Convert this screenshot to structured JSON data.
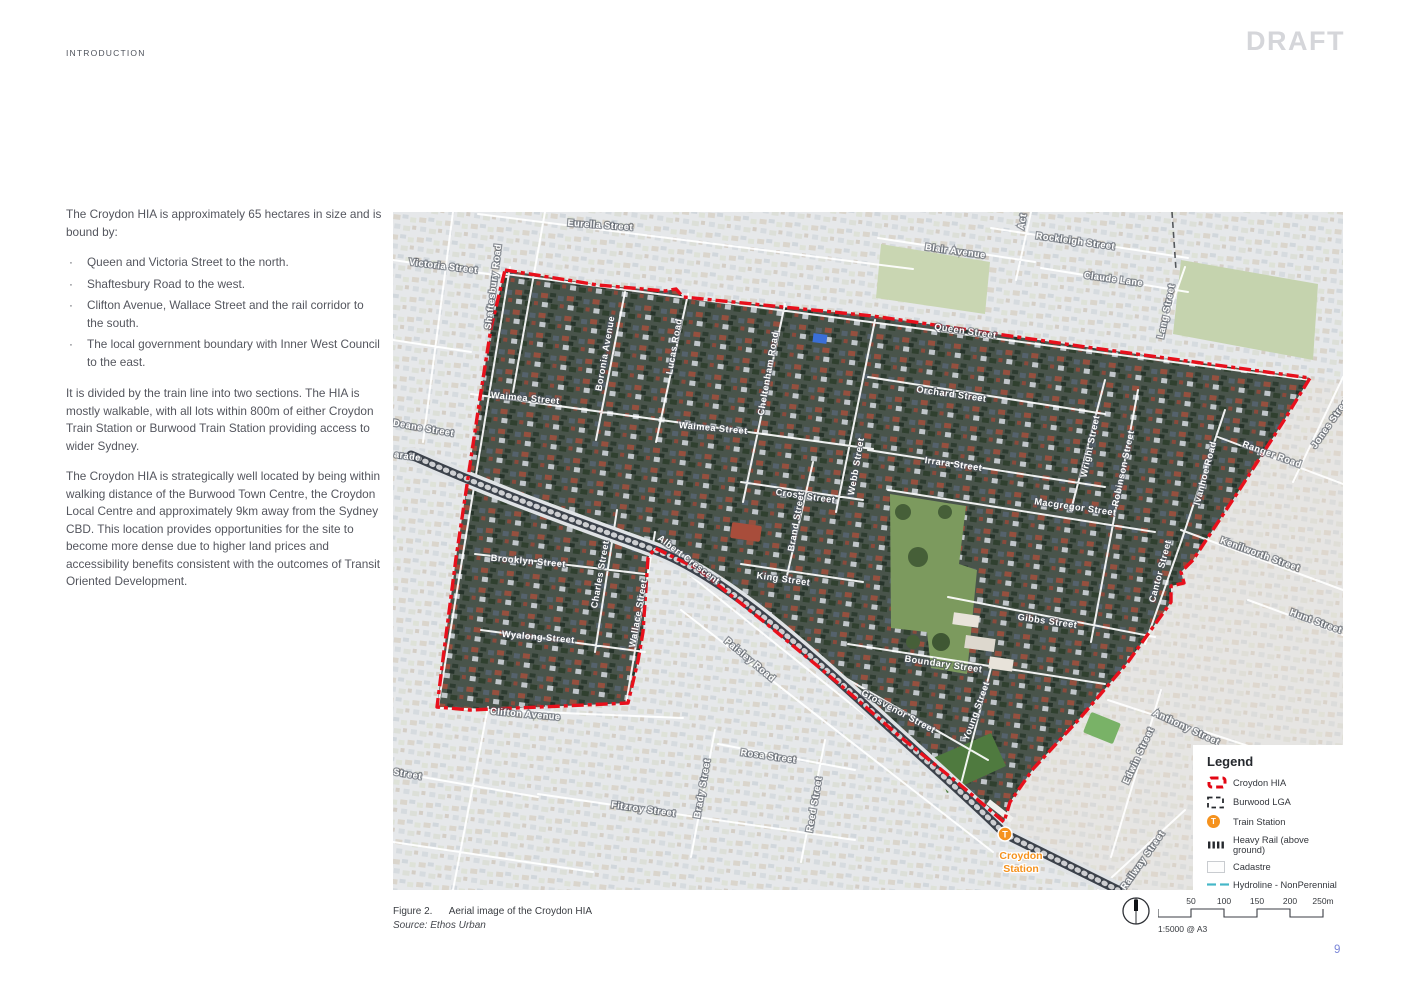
{
  "page": {
    "section_label": "INTRODUCTION",
    "watermark": "DRAFT",
    "page_number": "9"
  },
  "article": {
    "intro_paragraph": "The Croydon HIA is approximately 65 hectares in size and is bound by:",
    "bullets": [
      "Queen and Victoria Street to the north.",
      "Shaftesbury Road to the west.",
      "Clifton Avenue, Wallace Street and the rail corridor to the south.",
      "The local government boundary with Inner West Council to the east."
    ],
    "paragraphs": [
      "It is divided by the train line into two sections. The HIA is mostly walkable, with all lots within 800m of either Croydon Train Station or Burwood Train Station providing access to wider Sydney.",
      "The Croydon HIA is strategically well located by being within walking distance of the Burwood Town Centre, the Croydon Local Centre and approximately 9km away from the Sydney CBD. This location provides opportunities for the site to become more dense due to higher land prices and accessibility benefits consistent with the outcomes of Transit Oriented Development."
    ]
  },
  "figure": {
    "caption_label": "Figure 2.",
    "caption_text": "Aerial image of the Croydon HIA",
    "source": "Source: Ethos Urban",
    "scale_text": "1:5000 @ A3",
    "scale_ticks": [
      "50",
      "100",
      "150",
      "200",
      "250m"
    ],
    "station": {
      "marker": "T",
      "lines": [
        "Croydon",
        "Station"
      ]
    },
    "street_labels": [
      {
        "t": "Eurella Street",
        "x": 207,
        "y": 16,
        "r": 4
      },
      {
        "t": "Victoria Street",
        "x": 50,
        "y": 57,
        "r": 7
      },
      {
        "t": "Shaftesbury Road",
        "x": 103,
        "y": 75,
        "r": -83
      },
      {
        "t": "Blair Avenue",
        "x": 562,
        "y": 42,
        "r": 8
      },
      {
        "t": "Rockleigh Street",
        "x": 682,
        "y": 32,
        "r": 8
      },
      {
        "t": "Act",
        "x": 632,
        "y": 10,
        "r": -80
      },
      {
        "t": "Claude Lane",
        "x": 720,
        "y": 70,
        "r": 8
      },
      {
        "t": "Lang Street",
        "x": 776,
        "y": 100,
        "r": -78
      },
      {
        "t": "Queen Street",
        "x": 572,
        "y": 122,
        "r": 8
      },
      {
        "t": "Orchard Street",
        "x": 558,
        "y": 185,
        "r": 8
      },
      {
        "t": "Boronia Avenue",
        "x": 215,
        "y": 142,
        "r": -80
      },
      {
        "t": "Lucas Road",
        "x": 284,
        "y": 135,
        "r": -80
      },
      {
        "t": "Cheltenham Road",
        "x": 378,
        "y": 162,
        "r": -80
      },
      {
        "t": "Waimea Street",
        "x": 132,
        "y": 189,
        "r": 5
      },
      {
        "t": "Waimea Street",
        "x": 320,
        "y": 219,
        "r": 5
      },
      {
        "t": "Deane Street",
        "x": 30,
        "y": 219,
        "r": 10
      },
      {
        "t": "arade",
        "x": 14,
        "y": 247,
        "r": 8
      },
      {
        "t": "Irrara Street",
        "x": 560,
        "y": 255,
        "r": 8
      },
      {
        "t": "Cross Street",
        "x": 412,
        "y": 287,
        "r": 8
      },
      {
        "t": "Webb Street",
        "x": 466,
        "y": 255,
        "r": -80
      },
      {
        "t": "Brand Street",
        "x": 406,
        "y": 310,
        "r": -80
      },
      {
        "t": "King Street",
        "x": 390,
        "y": 370,
        "r": 8
      },
      {
        "t": "Wright Street",
        "x": 700,
        "y": 235,
        "r": -78
      },
      {
        "t": "Robinson Street",
        "x": 733,
        "y": 257,
        "r": -78
      },
      {
        "t": "Macgregor Street",
        "x": 682,
        "y": 298,
        "r": 8
      },
      {
        "t": "Ivanhoe Road",
        "x": 815,
        "y": 262,
        "r": -75
      },
      {
        "t": "Ranger Road",
        "x": 878,
        "y": 245,
        "r": 20
      },
      {
        "t": "Jones Street",
        "x": 940,
        "y": 212,
        "r": -55
      },
      {
        "t": "Kenilworth Street",
        "x": 866,
        "y": 345,
        "r": 20
      },
      {
        "t": "Hunt Street",
        "x": 922,
        "y": 412,
        "r": 20
      },
      {
        "t": "Cantor Street",
        "x": 770,
        "y": 360,
        "r": -75
      },
      {
        "t": "Gibbs Street",
        "x": 654,
        "y": 412,
        "r": 8
      },
      {
        "t": "Boundary Street",
        "x": 550,
        "y": 455,
        "r": 8
      },
      {
        "t": "Brooklyn Street",
        "x": 135,
        "y": 352,
        "r": 5
      },
      {
        "t": "Charles Street",
        "x": 210,
        "y": 363,
        "r": -80
      },
      {
        "t": "Wallace Street",
        "x": 248,
        "y": 402,
        "r": -80
      },
      {
        "t": "Albert Crescent",
        "x": 294,
        "y": 350,
        "r": 37
      },
      {
        "t": "Paisley Road",
        "x": 355,
        "y": 450,
        "r": 40
      },
      {
        "t": "Wyalong Street",
        "x": 145,
        "y": 428,
        "r": 5
      },
      {
        "t": "Clifton Avenue",
        "x": 132,
        "y": 505,
        "r": 5
      },
      {
        "t": "Street",
        "x": 14,
        "y": 565,
        "r": 10
      },
      {
        "t": "Rosa Street",
        "x": 375,
        "y": 547,
        "r": 8
      },
      {
        "t": "Fitzroy Street",
        "x": 250,
        "y": 600,
        "r": 8
      },
      {
        "t": "Brady Street",
        "x": 312,
        "y": 577,
        "r": -80
      },
      {
        "t": "Reed Street",
        "x": 424,
        "y": 593,
        "r": -80
      },
      {
        "t": "Grosvenor Street",
        "x": 504,
        "y": 502,
        "r": 28
      },
      {
        "t": "Young Street",
        "x": 586,
        "y": 500,
        "r": -70
      },
      {
        "t": "Edwin Street",
        "x": 748,
        "y": 545,
        "r": -65
      },
      {
        "t": "Anthony Street",
        "x": 792,
        "y": 518,
        "r": 25
      },
      {
        "t": "Railway Street",
        "x": 752,
        "y": 650,
        "r": -55
      }
    ]
  },
  "legend": {
    "title": "Legend",
    "items": [
      {
        "icon": "croydon-hia",
        "label": "Croydon HIA"
      },
      {
        "icon": "burwood-lga",
        "label": "Burwood LGA"
      },
      {
        "icon": "train-station",
        "label": "Train Station"
      },
      {
        "icon": "heavy-rail",
        "label": "Heavy Rail (above ground)"
      },
      {
        "icon": "cadastre",
        "label": "Cadastre"
      },
      {
        "icon": "hydroline",
        "label": "Hydroline - NonPerennial"
      }
    ]
  },
  "colors": {
    "hia_red": "#e8101c",
    "station_orange": "#f5921e",
    "hydro_teal": "#45b7c8",
    "page_number_blue": "#7b86d8",
    "draft_gray": "#d5d6da"
  }
}
